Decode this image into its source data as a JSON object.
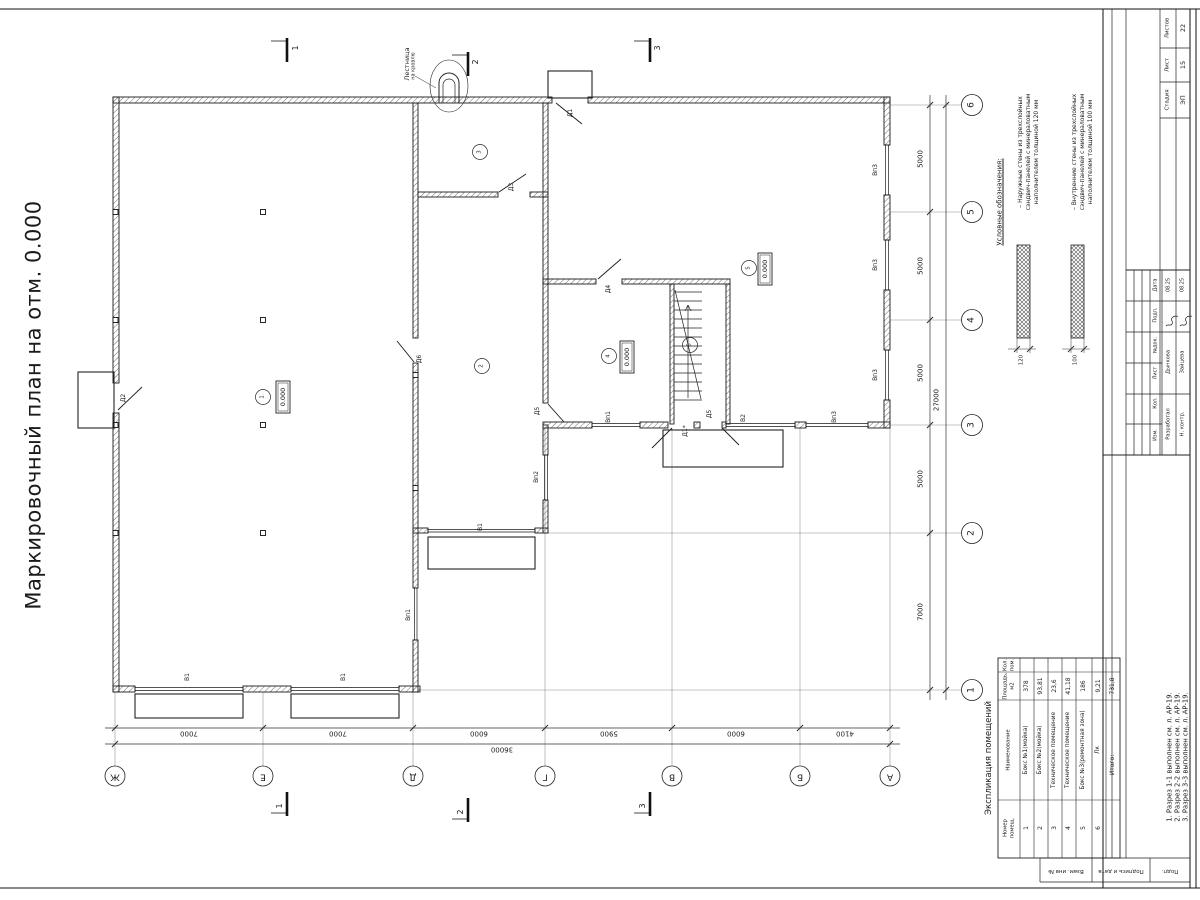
{
  "title": "Маркировочный план на отм. 0.000",
  "legend": {
    "title": "Условные обозначения:",
    "items": [
      {
        "lines": [
          "– Наружные стены из трехслойных",
          "сэндвич-панелей с минераловатным",
          "наполнителем толщиной 120 мм"
        ],
        "dim": "120"
      },
      {
        "lines": [
          "– Внутренние стены из трехслойных",
          "сэндвич-панелей с минераловатным",
          "наполнителем толщиной 100 мм"
        ],
        "dim": "100"
      }
    ]
  },
  "schedule": {
    "title": "Экспликация помещений",
    "headers": [
      [
        "Номер",
        "помещ."
      ],
      [
        "Наименование"
      ],
      [
        "Площадь,",
        "м2"
      ],
      [
        "Кол.",
        "пом."
      ]
    ],
    "rows": [
      [
        "1",
        "Бокс №1(мойка)",
        "378"
      ],
      [
        "2",
        "Бокс №2(мойка)",
        "93,81"
      ],
      [
        "3",
        "Техническое помещение",
        "23,6"
      ],
      [
        "4",
        "Техническое помещение",
        "41,18"
      ],
      [
        "5",
        "Бокс №3(ремонтная зона)",
        "186"
      ],
      [
        "6",
        "Лк",
        "9,21"
      ]
    ],
    "total_label": "Итого:",
    "total_value": "731,8"
  },
  "notes": [
    "1. Разрез 1-1 выполнен см. л. АР-19.",
    "2. Разрез 2-2 выполнен см. л. АР-19.",
    "3. Разрез 3-3 выполнен см. л. АР-19."
  ],
  "axes": {
    "letters": [
      "Ж",
      "Е",
      "Д",
      "Г",
      "В",
      "Б",
      "А"
    ],
    "numbers": [
      "6",
      "5",
      "4",
      "3",
      "2",
      "1"
    ]
  },
  "dims": {
    "bottom": [
      "7000",
      "7000",
      "6000",
      "5900",
      "6000",
      "4100"
    ],
    "bottom_total": "36000",
    "right": [
      "5000",
      "5000",
      "5000",
      "5000",
      "7000"
    ],
    "right_total": "27000"
  },
  "plan": {
    "elevation": "0.000",
    "roof_ladder": [
      "Лестница",
      "на кровлю"
    ],
    "doors": [
      {
        "t": "Д1",
        "x": 571,
        "y": 113
      },
      {
        "t": "Д2",
        "x": 124,
        "y": 398
      },
      {
        "t": "Д3",
        "x": 512,
        "y": 187
      },
      {
        "t": "Д4",
        "x": 609,
        "y": 289
      },
      {
        "t": "Д5",
        "x": 538,
        "y": 411
      },
      {
        "t": "Д5",
        "x": 710,
        "y": 414
      },
      {
        "t": "Д6",
        "x": 420,
        "y": 359
      },
      {
        "t": "Д1*",
        "x": 686,
        "y": 431
      }
    ],
    "windows": [
      {
        "t": "В1",
        "x": 188,
        "y": 677
      },
      {
        "t": "В1",
        "x": 344,
        "y": 677
      },
      {
        "t": "В1",
        "x": 481,
        "y": 527
      },
      {
        "t": "В2",
        "x": 744,
        "y": 418
      },
      {
        "t": "Вп1",
        "x": 609,
        "y": 417
      },
      {
        "t": "Вп1",
        "x": 409,
        "y": 615
      },
      {
        "t": "Вп2",
        "x": 537,
        "y": 477
      },
      {
        "t": "Вп3",
        "x": 876,
        "y": 170
      },
      {
        "t": "Вп3",
        "x": 876,
        "y": 265
      },
      {
        "t": "Вп3",
        "x": 876,
        "y": 375
      },
      {
        "t": "Вп3",
        "x": 835,
        "y": 417
      }
    ],
    "rooms": [
      {
        "n": "1",
        "x": 263,
        "y": 397,
        "ex": 283,
        "ey": 397
      },
      {
        "n": "2",
        "x": 482,
        "y": 366
      },
      {
        "n": "3",
        "x": 480,
        "y": 152
      },
      {
        "n": "4",
        "x": 609,
        "y": 356,
        "ex": 627,
        "ey": 357
      },
      {
        "n": "5",
        "x": 749,
        "y": 268,
        "ex": 765,
        "ey": 269
      },
      {
        "n": "6",
        "x": 690,
        "y": 345
      }
    ],
    "sections": {
      "labels": [
        "1",
        "2",
        "3"
      ],
      "top": [
        [
          296,
          48
        ],
        [
          476,
          62
        ],
        [
          658,
          48
        ]
      ],
      "bottom": [
        [
          280,
          806
        ],
        [
          461,
          812
        ],
        [
          643,
          806
        ]
      ]
    }
  },
  "title_block": {
    "stage_headers": [
      "Стадия",
      "Лист",
      "Листов"
    ],
    "stage_values": [
      "ЭП",
      "15",
      "22"
    ],
    "columns": [
      "Дата",
      "Подп.",
      "№док.",
      "Лист",
      "Кол.",
      "Изм."
    ],
    "rows": [
      {
        "role": "Разработал",
        "name": "Дынкова",
        "date": "08.25"
      },
      {
        "role": "Н. контр.",
        "name": "Зайцева",
        "date": "08.25"
      }
    ],
    "side_cells": [
      "Взам. инв №",
      "Подпись и дата",
      "Подп."
    ]
  }
}
